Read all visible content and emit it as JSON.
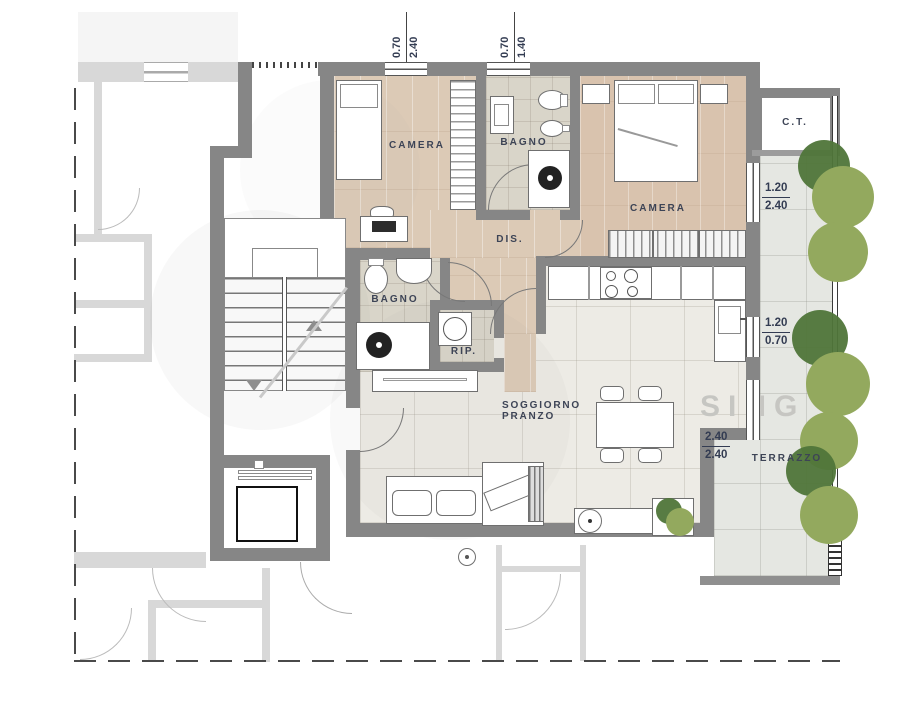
{
  "rooms": {
    "camera1": "CAMERA",
    "bagno1": "BAGNO",
    "camera2": "CAMERA",
    "dis": "DIS.",
    "bagno2": "BAGNO",
    "rip": "RIP.",
    "soggiorno1": "SOGGIORNO",
    "soggiorno2": "PRANZO",
    "terrazzo": "TERRAZZO",
    "ct": "C.T."
  },
  "dims": {
    "top1": {
      "a": "0.70",
      "b": "2.40"
    },
    "top2": {
      "a": "0.70",
      "b": "1.40"
    },
    "right1": {
      "a": "1.20",
      "b": "2.40"
    },
    "right2": {
      "a": "1.20",
      "b": "0.70"
    },
    "terrace_door": {
      "a": "2.40",
      "b": "2.40"
    }
  },
  "watermark": "SING",
  "colors": {
    "wall": "#868686",
    "wall_light": "#d8d8d8",
    "wood": "#dccab6",
    "bath_tile": "#d9d5c9",
    "living_tile": "#edebe5",
    "terrace_tile": "#e5e7e2",
    "tree_dark": "#4f7539",
    "tree_light": "#93a95e",
    "label": "#3d4456"
  }
}
